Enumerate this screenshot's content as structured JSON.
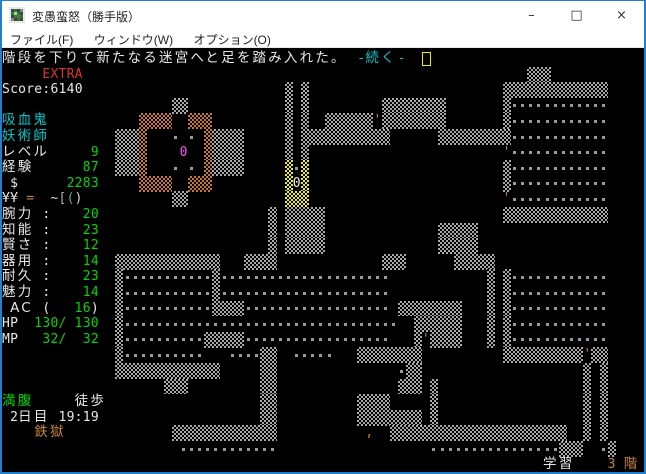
{
  "window": {
    "title": "変愚蛮怒（勝手版）",
    "controls": {
      "minimize": "–",
      "maximize": "□",
      "close": "×"
    }
  },
  "menu": {
    "items": [
      {
        "label": "ファイル(F)"
      },
      {
        "label": "ウィンドウ(W)"
      },
      {
        "label": "オプション(O)"
      }
    ]
  },
  "palette": {
    "white": "#e8e8e8",
    "green": "#00d800",
    "cyan": "#00c8c8",
    "red": "#e03030",
    "orange": "#c8823c",
    "magenta": "#ff55ff",
    "yellow": "#f0f000",
    "gray": "#b0b0b0",
    "ltgray": "#d0d0d0",
    "dullgreen": "#66aa66"
  },
  "terminal": {
    "cols": 80,
    "rows": 27,
    "cell_w": 8.075,
    "cell_h": 15.6,
    "origin_y": 50,
    "cursor": {
      "row": 0,
      "col": 52
    },
    "lines": [
      {
        "row": 0,
        "segments": [
          {
            "col": 0,
            "text": "階段を下りて新たなる迷宮へと足を踏み入れた。",
            "color": "white",
            "font": "cjk"
          },
          {
            "col": 44,
            "text": "-",
            "color": "cyan",
            "font": "mono"
          },
          {
            "col": 45,
            "text": "続く",
            "color": "cyan",
            "font": "cjk"
          },
          {
            "col": 49,
            "text": "-",
            "color": "cyan",
            "font": "mono"
          }
        ]
      },
      {
        "row": 1,
        "segments": [
          {
            "col": 5,
            "text": "EXTRA",
            "color": "red",
            "font": "mono"
          }
        ]
      },
      {
        "row": 2,
        "segments": [
          {
            "col": 0,
            "text": "Score:6140",
            "color": "white",
            "font": "mono"
          }
        ]
      },
      {
        "row": 4,
        "segments": [
          {
            "col": 0,
            "text": "吸血鬼",
            "color": "cyan",
            "font": "cjk"
          }
        ]
      },
      {
        "row": 5,
        "segments": [
          {
            "col": 0,
            "text": "妖術師",
            "color": "cyan",
            "font": "cjk"
          }
        ]
      },
      {
        "row": 6,
        "segments": [
          {
            "col": 0,
            "text": "レベル",
            "color": "white",
            "font": "cjk"
          },
          {
            "col": 11,
            "text": "9",
            "color": "green",
            "font": "mono"
          }
        ]
      },
      {
        "row": 7,
        "segments": [
          {
            "col": 0,
            "text": "経験",
            "color": "white",
            "font": "cjk"
          },
          {
            "col": 10,
            "text": "87",
            "color": "green",
            "font": "mono"
          }
        ]
      },
      {
        "row": 8,
        "segments": [
          {
            "col": 1,
            "text": "$",
            "color": "white",
            "font": "mono"
          },
          {
            "col": 8,
            "text": "2283",
            "color": "green",
            "font": "mono"
          }
        ]
      },
      {
        "row": 9,
        "segments": [
          {
            "col": 0,
            "text": "¥¥",
            "color": "white",
            "font": "mono"
          },
          {
            "col": 3,
            "text": "=",
            "color": "orange",
            "font": "mono"
          },
          {
            "col": 6,
            "text": "~",
            "color": "ltgray",
            "font": "mono"
          },
          {
            "col": 7,
            "text": "[",
            "color": "gray",
            "font": "mono"
          },
          {
            "col": 8,
            "text": "(",
            "color": "dullgreen",
            "font": "mono"
          },
          {
            "col": 9,
            "text": ")",
            "color": "ltgray",
            "font": "mono"
          }
        ]
      },
      {
        "row": 10,
        "segments": [
          {
            "col": 0,
            "text": "腕力",
            "color": "white",
            "font": "cjk"
          },
          {
            "col": 5,
            "text": ":",
            "color": "white",
            "font": "mono"
          },
          {
            "col": 10,
            "text": "20",
            "color": "green",
            "font": "mono"
          }
        ]
      },
      {
        "row": 11,
        "segments": [
          {
            "col": 0,
            "text": "知能",
            "color": "white",
            "font": "cjk"
          },
          {
            "col": 5,
            "text": ":",
            "color": "white",
            "font": "mono"
          },
          {
            "col": 10,
            "text": "23",
            "color": "green",
            "font": "mono"
          }
        ]
      },
      {
        "row": 12,
        "segments": [
          {
            "col": 0,
            "text": "賢さ",
            "color": "white",
            "font": "cjk"
          },
          {
            "col": 5,
            "text": ":",
            "color": "white",
            "font": "mono"
          },
          {
            "col": 10,
            "text": "12",
            "color": "green",
            "font": "mono"
          }
        ]
      },
      {
        "row": 13,
        "segments": [
          {
            "col": 0,
            "text": "器用",
            "color": "white",
            "font": "cjk"
          },
          {
            "col": 5,
            "text": ":",
            "color": "white",
            "font": "mono"
          },
          {
            "col": 10,
            "text": "14",
            "color": "green",
            "font": "mono"
          }
        ]
      },
      {
        "row": 14,
        "segments": [
          {
            "col": 0,
            "text": "耐久",
            "color": "white",
            "font": "cjk"
          },
          {
            "col": 5,
            "text": ":",
            "color": "white",
            "font": "mono"
          },
          {
            "col": 10,
            "text": "23",
            "color": "green",
            "font": "mono"
          }
        ]
      },
      {
        "row": 15,
        "segments": [
          {
            "col": 0,
            "text": "魅力",
            "color": "white",
            "font": "cjk"
          },
          {
            "col": 5,
            "text": ":",
            "color": "white",
            "font": "mono"
          },
          {
            "col": 10,
            "text": "14",
            "color": "green",
            "font": "mono"
          }
        ]
      },
      {
        "row": 16,
        "segments": [
          {
            "col": 1,
            "text": "AC",
            "color": "white",
            "font": "cjk"
          },
          {
            "col": 5,
            "text": "(",
            "color": "white",
            "font": "mono"
          },
          {
            "col": 9,
            "text": "16",
            "color": "green",
            "font": "mono"
          },
          {
            "col": 11,
            "text": ")",
            "color": "white",
            "font": "mono"
          }
        ]
      },
      {
        "row": 17,
        "segments": [
          {
            "col": 0,
            "text": "HP",
            "color": "white",
            "font": "mono"
          },
          {
            "col": 4,
            "text": "130/",
            "color": "green",
            "font": "mono"
          },
          {
            "col": 9,
            "text": "130",
            "color": "green",
            "font": "mono"
          }
        ]
      },
      {
        "row": 18,
        "segments": [
          {
            "col": 0,
            "text": "MP",
            "color": "white",
            "font": "mono"
          },
          {
            "col": 5,
            "text": "32/",
            "color": "green",
            "font": "mono"
          },
          {
            "col": 10,
            "text": "32",
            "color": "green",
            "font": "mono"
          }
        ]
      },
      {
        "row": 22,
        "segments": [
          {
            "col": 0,
            "text": "満腹",
            "color": "green",
            "font": "cjk"
          },
          {
            "col": 9,
            "text": "徒歩",
            "color": "white",
            "font": "cjk"
          }
        ]
      },
      {
        "row": 23,
        "segments": [
          {
            "col": 1,
            "text": "2",
            "color": "white",
            "font": "mono"
          },
          {
            "col": 2,
            "text": "日目",
            "color": "white",
            "font": "cjk"
          },
          {
            "col": 7,
            "text": "19:19",
            "color": "white",
            "font": "mono"
          }
        ]
      },
      {
        "row": 24,
        "segments": [
          {
            "col": 4,
            "text": "鉄獄",
            "color": "orange",
            "font": "cjk"
          }
        ]
      },
      {
        "row": 26,
        "segments": [
          {
            "col": 67,
            "text": "学習",
            "color": "white",
            "font": "cjk"
          },
          {
            "col": 75,
            "text": "3",
            "color": "orange",
            "font": "mono"
          },
          {
            "col": 77,
            "text": "階",
            "color": "orange",
            "font": "cjk"
          }
        ]
      }
    ]
  },
  "map": {
    "origin_row": 1,
    "legend": {
      "#": "gray-wall",
      "o": "orange-wall",
      "y": "yellow-wall",
      ".": "floor-dot",
      "'": "open-door",
      ",": "item",
      "m": "monster-0-magenta",
      "W": "monster-0-white"
    },
    "rows": [
      "                                                                 ###            ",
      "                                   # #                        #############     ",
      "                     ##            # #         ########       #............     ",
      "                 oooo  ooo         # #  ######'########       #............     ",
      "              ###o   . . o####     # ###########      #########............     ",
      "              ###o    m  o####     # #                        '............     ",
      "              ###o   . . o####     y.y                        #............     ",
      "                 oooo  ooo         yWy                        #............     ",
      "                     ##            yyy                        '............     ",
      "                                 # #####                      #############     ",
      "                                 # #####              #####                    ",
      "                                 # #####              #####                    ",
      "              #############   ####             ###      #####",
      "              #...........#.....................            # #............     ",
      "              #...........#.....................            # #............     ",
      "              #...........####.................. ########   # #............     ",
      "              #..................................  ######   # #............     ",
      "              #..........#####..................   #'####   # #............     ",
      "              #..........   ....##  .....   ########          ##########'##     ",
      "              #############     ##               .##                    # #     ",
      "                    ###         ##               ### #                  # #     ",
      "                                ##          ####     #                  # #     ",
      "                                ##          ######## #                  # #     ",
      "                     #############           ,  ######################  # #     ",
      "                      ............                   ................###  .#    "
    ]
  }
}
